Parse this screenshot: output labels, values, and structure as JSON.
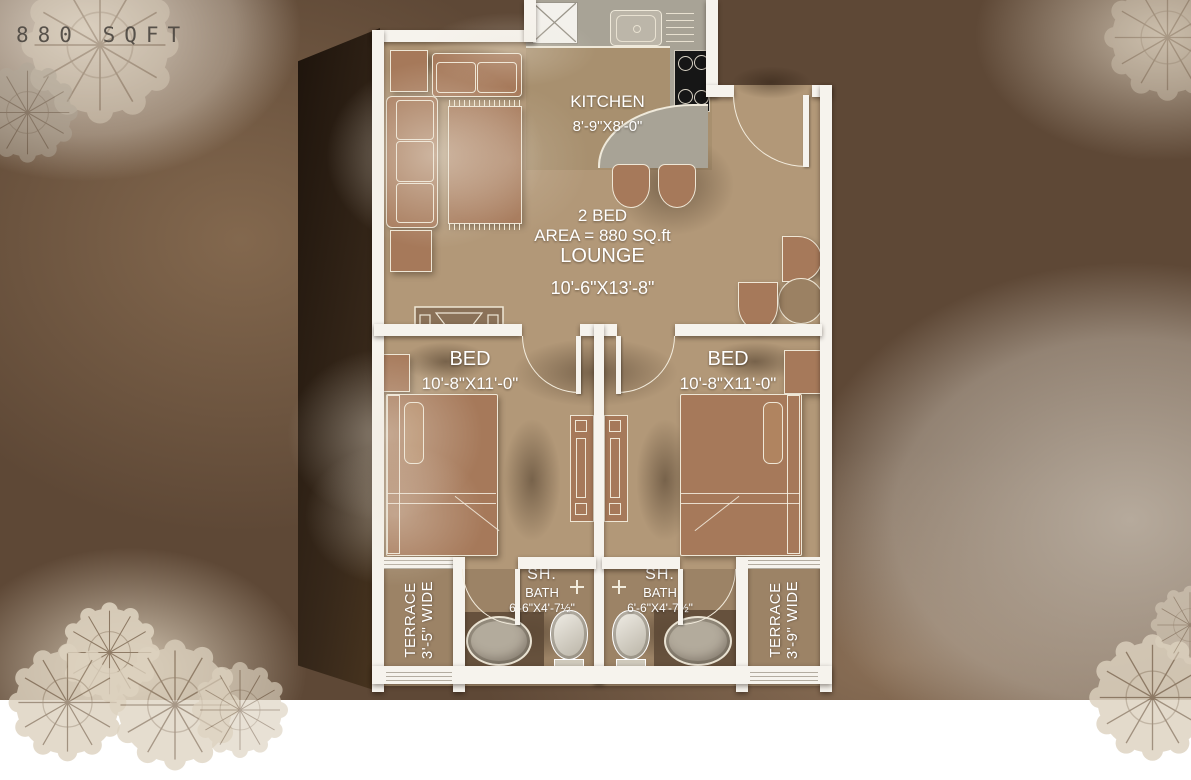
{
  "header": {
    "type_label": "2 BED",
    "area_label": "880 SQFT"
  },
  "plan": {
    "kitchen": {
      "name": "KITCHEN",
      "dims": "8'-9\"X8'-0\""
    },
    "lounge": {
      "unit_type": "2 BED",
      "unit_area": "AREA = 880 SQ.ft",
      "name": "LOUNGE",
      "dims": "10'-6\"X13'-8\""
    },
    "bedroom_left": {
      "name": "BED",
      "dims": "10'-8\"X11'-0\""
    },
    "bedroom_right": {
      "name": "BED",
      "dims": "10'-8\"X11'-0\""
    },
    "bath_left": {
      "shower_label": "SH.",
      "name": "BATH",
      "dims": "6'-6\"X4'-7½\""
    },
    "bath_right": {
      "shower_label": "SH.",
      "name": "BATH",
      "dims": "6'-6\"X4'-7½\""
    },
    "terrace_left": {
      "name": "TERRACE",
      "dims": "3'-5\" WIDE"
    },
    "terrace_right": {
      "name": "TERRACE",
      "dims": "3'-9\" WIDE"
    }
  },
  "palette": {
    "background": "#5e4836",
    "floor": "#b29878",
    "kitchen_floor": "#a8906f",
    "counter_gray": "#a8a396",
    "furniture_brown": "#a6795a",
    "wall_white": "#f6f3ed",
    "stove_black": "#161616",
    "label_text": "#ffffff",
    "header_text": "#4a453f"
  }
}
